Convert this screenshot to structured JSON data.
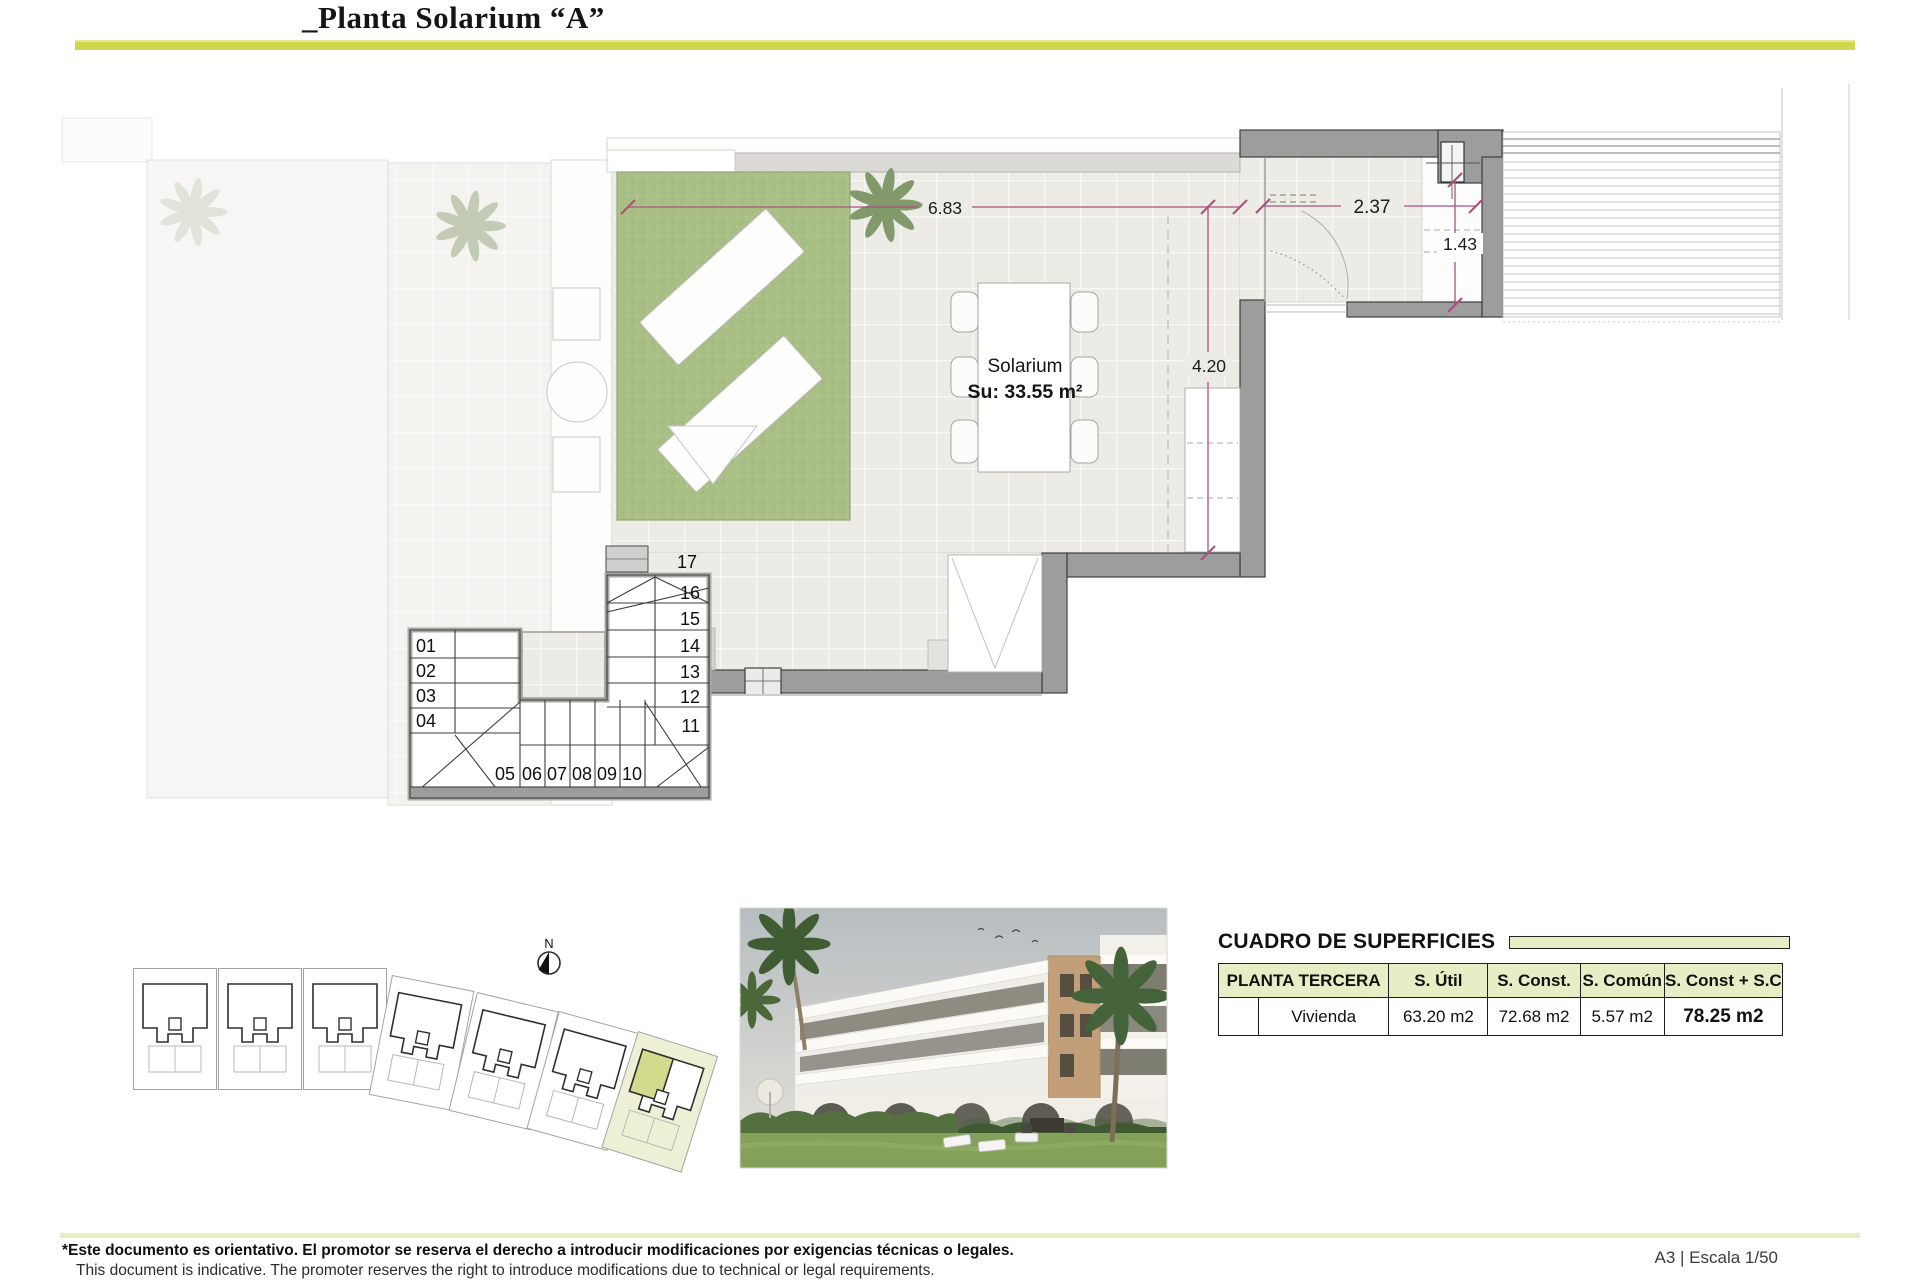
{
  "header": {
    "title": "_Planta Solarium “A”"
  },
  "plan": {
    "room_label": "Solarium",
    "room_area": "Su: 33.55 m²",
    "dims": {
      "terrace_width": "6.83",
      "storage_width": "2.37",
      "storage_depth": "1.43",
      "terrace_depth": "4.20"
    },
    "stair_numbers": [
      "01",
      "02",
      "03",
      "04",
      "05",
      "06",
      "07",
      "08",
      "09",
      "10",
      "11",
      "12",
      "13",
      "14",
      "15",
      "16",
      "17"
    ],
    "north_label": "N"
  },
  "surfaces_table": {
    "title": "CUADRO DE SUPERFICIES",
    "columns": [
      "PLANTA TERCERA",
      "S. Útil",
      "S. Const.",
      "S. Común",
      "S. Const + S.C"
    ],
    "row": [
      "Vivienda",
      "63.20 m2",
      "72.68 m2",
      "5.57 m2",
      "78.25 m2"
    ]
  },
  "footer": {
    "disclaimer_es": "*Este documento es orientativo. El promotor se reserva el derecho a introducir modificaciones por exigencias técnicas o legales.",
    "disclaimer_en": "This document is indicative. The promoter reserves the right to introduce modifications due to technical or legal requirements.",
    "sheet_info": "A3 | Escala 1/50"
  },
  "colors": {
    "accent_line": "#cfd84d",
    "table_header_bg": "#e9edc6",
    "highlight_unit": "#d4da8c",
    "highlight_parcel": "#eef0d6",
    "grass": "#a9bf85",
    "dimension": "#ad5080",
    "wall_dark": "#9d9d9d"
  }
}
